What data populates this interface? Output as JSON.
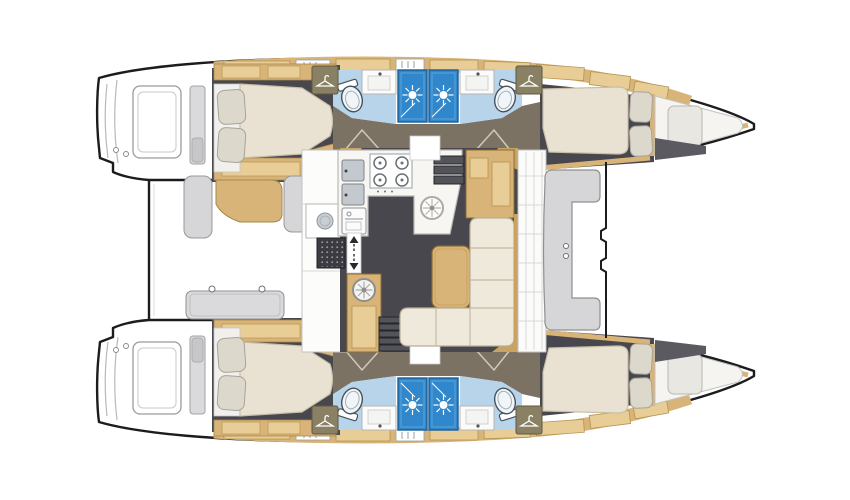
{
  "scene": {
    "kind": "catamaran-floorplan-top-view",
    "orientation": "bow-right-stern-left"
  },
  "colors": {
    "outline": "#1c1c1e",
    "background": "#ffffff",
    "cabin_floor": "#47474d",
    "wood": "#d9b478",
    "wood_light": "#e8cd96",
    "wood_dark": "#c8a362",
    "mattress": "#e9e2d2",
    "pillow": "#dcd8cc",
    "settee_cream": "#efe9db",
    "bathroom_floor": "#b7d4eb",
    "shower_blue": "#3187cb",
    "corridor_taupe": "#7b7264",
    "bench_gray": "#d6d6d8",
    "counter_white": "#f7f6f2",
    "mat_dark": "#3b3b41",
    "steel": "#c3c9cf",
    "berth_white": "#f5f4f0"
  },
  "icons": [
    {
      "name": "shower-head-icon",
      "glyph": "sunburst"
    },
    {
      "name": "wardrobe-hanger-icon",
      "glyph": "coat-hanger"
    },
    {
      "name": "deck-hatch-fan-icon",
      "glyph": "spoked-circle"
    },
    {
      "name": "companionway-arrows-icon",
      "glyph": "up-down-arrows"
    },
    {
      "name": "stove-icon",
      "glyph": "four-burner-hob"
    },
    {
      "name": "sink-icon",
      "glyph": "double-basin"
    },
    {
      "name": "toilet-icon",
      "glyph": "oval-bowl"
    }
  ],
  "regions": [
    {
      "name": "aft-cabin-hull-top"
    },
    {
      "name": "forward-cabin-hull-top"
    },
    {
      "name": "bathrooms-hull-top"
    },
    {
      "name": "aft-cabin-hull-bottom"
    },
    {
      "name": "forward-cabin-hull-bottom"
    },
    {
      "name": "bathrooms-hull-bottom"
    },
    {
      "name": "salon-galley"
    },
    {
      "name": "dinette-settee"
    },
    {
      "name": "navigation-station"
    },
    {
      "name": "aft-cockpit"
    },
    {
      "name": "forward-cockpit"
    },
    {
      "name": "trampoline"
    },
    {
      "name": "swim-platforms"
    }
  ]
}
